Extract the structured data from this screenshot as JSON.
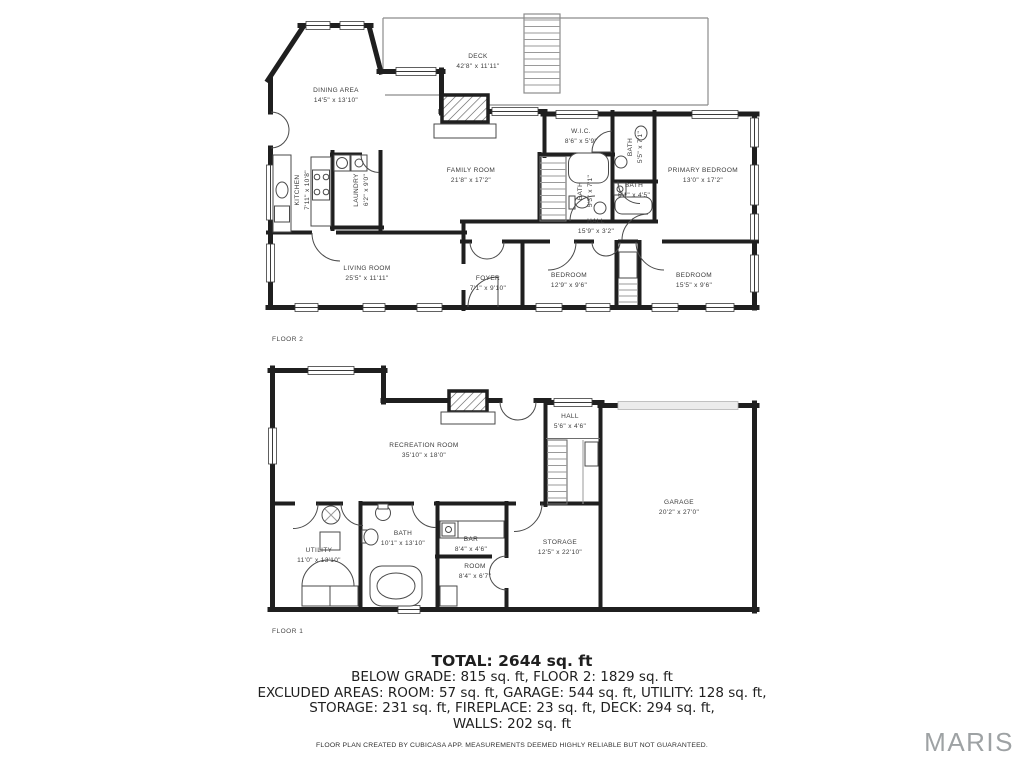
{
  "floor2": {
    "caption": "FLOOR 2",
    "rooms": [
      {
        "name": "DECK",
        "dims": "42'8\" x 11'11\""
      },
      {
        "name": "DINING AREA",
        "dims": "14'5\" x 13'10\""
      },
      {
        "name": "FAMILY ROOM",
        "dims": "21'8\" x 17'2\""
      },
      {
        "name": "W.I.C.",
        "dims": "8'6\" x 5'9\""
      },
      {
        "name": "BATH",
        "dims": "5'5\" x 7'1\""
      },
      {
        "name": "PRIMARY BEDROOM",
        "dims": "13'0\" x 17'2\""
      },
      {
        "name": "KITCHEN",
        "dims": "7'11\" x 10'8\""
      },
      {
        "name": "LAUNDRY",
        "dims": "6'2\" x 9'0\""
      },
      {
        "name": "BATH",
        "dims": "5'3\" x 7'1\""
      },
      {
        "name": "BATH",
        "dims": "6'1\" x 4'5\""
      },
      {
        "name": "HALL",
        "dims": "15'9\" x 3'2\""
      },
      {
        "name": "LIVING ROOM",
        "dims": "25'5\" x 11'11\""
      },
      {
        "name": "FOYER",
        "dims": "7'1\" x 9'10\""
      },
      {
        "name": "BEDROOM",
        "dims": "12'9\" x 9'6\""
      },
      {
        "name": "BEDROOM",
        "dims": "15'5\" x 9'6\""
      }
    ]
  },
  "floor1": {
    "caption": "FLOOR 1",
    "rooms": [
      {
        "name": "RECREATION ROOM",
        "dims": "35'10\" x 18'0\""
      },
      {
        "name": "HALL",
        "dims": "5'6\" x 4'6\""
      },
      {
        "name": "GARAGE",
        "dims": "20'2\" x 27'0\""
      },
      {
        "name": "UTILITY",
        "dims": "11'0\" x 13'10\""
      },
      {
        "name": "BATH",
        "dims": "10'1\" x 13'10\""
      },
      {
        "name": "BAR",
        "dims": "8'4\" x 4'6\""
      },
      {
        "name": "ROOM",
        "dims": "8'4\" x 6'7\""
      },
      {
        "name": "STORAGE",
        "dims": "12'5\" x 22'10\""
      }
    ]
  },
  "summary": {
    "total": "TOTAL: 2644 sq. ft",
    "line2": "BELOW GRADE: 815 sq. ft, FLOOR 2: 1829 sq. ft",
    "line3": "EXCLUDED AREAS: ROOM: 57 sq. ft, GARAGE: 544 sq. ft, UTILITY: 128 sq. ft,",
    "line4": "STORAGE: 231 sq. ft, FIREPLACE: 23 sq. ft, DECK: 294 sq. ft,",
    "line5": "WALLS: 202 sq. ft"
  },
  "disclaimer": "FLOOR PLAN CREATED BY CUBICASA APP. MEASUREMENTS DEEMED HIGHLY RELIABLE BUT NOT GUARANTEED.",
  "watermark": "MARIS",
  "colors": {
    "wall": "#1f1f1f",
    "label": "#3b3b3b",
    "watermark": "#9ea2a4"
  }
}
